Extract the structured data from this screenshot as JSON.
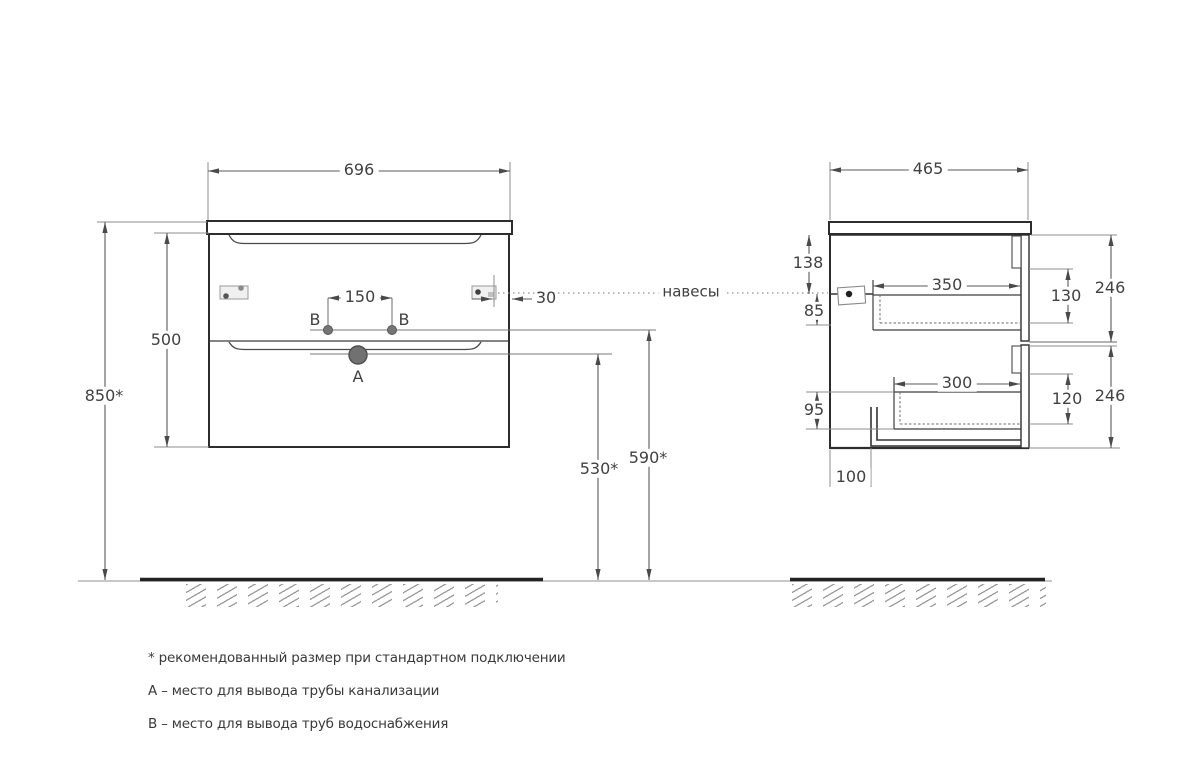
{
  "front": {
    "width": "696",
    "cabinet_height": "500",
    "mount_height": "850*",
    "outlet_spacing": "150",
    "hanger_inset": "30",
    "drain_height": "530*",
    "water_height": "590*",
    "label_a": "A",
    "label_b_left": "B",
    "label_b_right": "B"
  },
  "side": {
    "depth": "465",
    "hanger_from_top": "138",
    "hanger_to_box": "85",
    "drawer_top_depth": "350",
    "drawer_top_box_height": "130",
    "front_top_height": "246",
    "drawer_bottom_depth": "300",
    "drawer_bottom_box_height": "120",
    "front_bottom_height": "246",
    "bottom_clearance": "95",
    "pipe_offset": "100"
  },
  "callout": {
    "hangers": "навесы"
  },
  "notes": [
    "* рекомендованный размер при стандартном подключении",
    "A – место для вывода трубы канализации",
    "B – место для вывода труб водоснабжения"
  ],
  "colors": {
    "outline": "#2d2d2d",
    "dimension": "#5a5a5a",
    "extension": "#8c8c8c",
    "text": "#3d3d3d",
    "dot_fill": "#757575",
    "floor": "#222222"
  }
}
